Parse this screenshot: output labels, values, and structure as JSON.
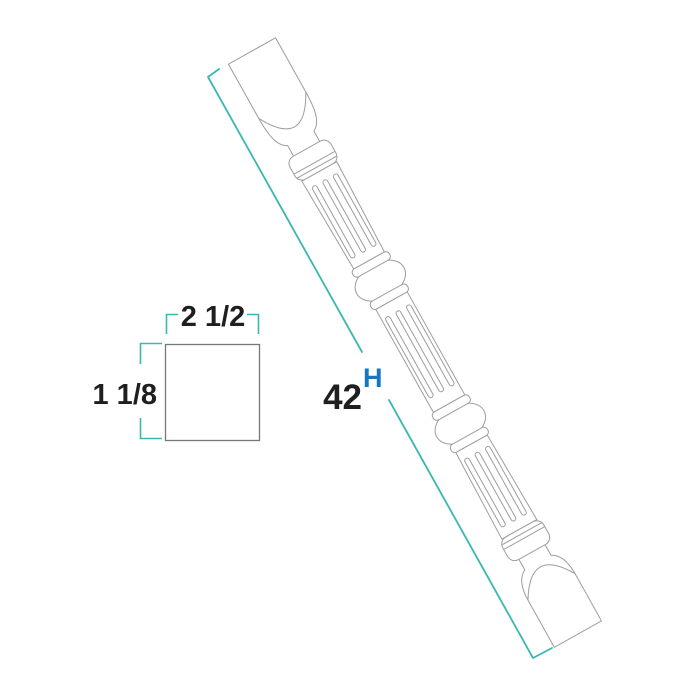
{
  "colors": {
    "background": "#ffffff",
    "outline": "#9d9d9d",
    "cross_section_outline": "#777777",
    "dimension": "#3bb7b1",
    "text": "#1f1f1f",
    "height_letter": "#1477c0"
  },
  "height_dimension": {
    "value": "42",
    "label": "H"
  },
  "cross_section": {
    "top_dimension": "2 1/2",
    "side_dimension": "1 1/8"
  }
}
